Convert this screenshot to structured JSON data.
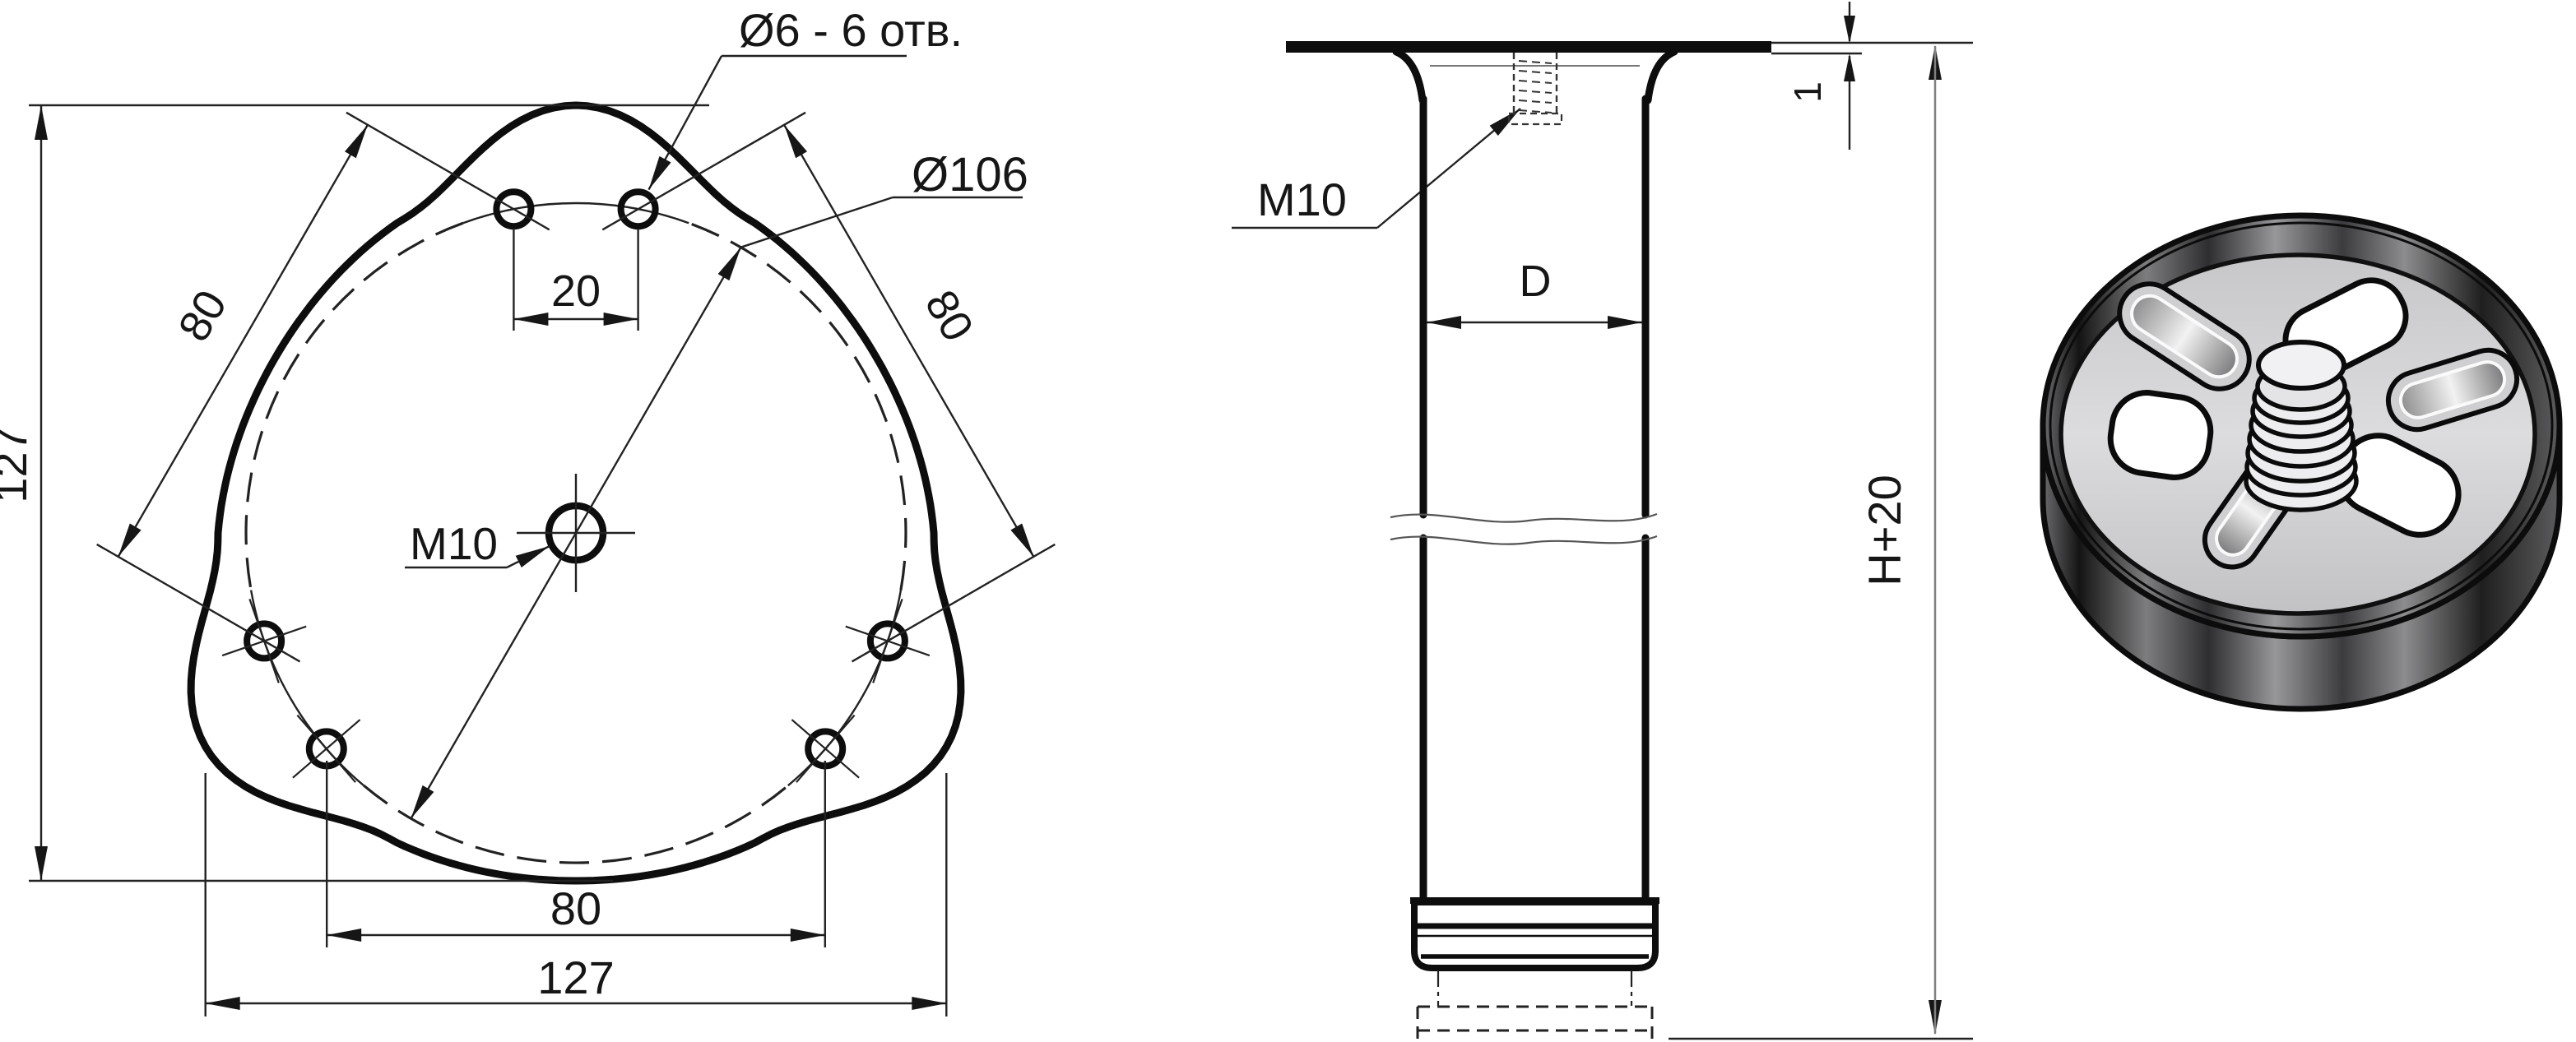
{
  "top_view": {
    "label_holes": "Ø6 - 6 отв.",
    "label_bolt_circle": "Ø106",
    "label_center_thread": "M10",
    "dim_height": "127",
    "dim_width": "127",
    "dim_pair_spacing": "20",
    "dim_bottom_spacing": "80",
    "dim_left_diag": "80",
    "dim_right_diag": "80"
  },
  "side_view": {
    "label_thread": "M10",
    "dim_diameter": "D",
    "dim_height": "H+20",
    "dim_plate_thickness": "1"
  },
  "colors": {
    "line": "#111111",
    "dim_line": "#222222",
    "aux_line": "#808080",
    "background": "#ffffff"
  }
}
